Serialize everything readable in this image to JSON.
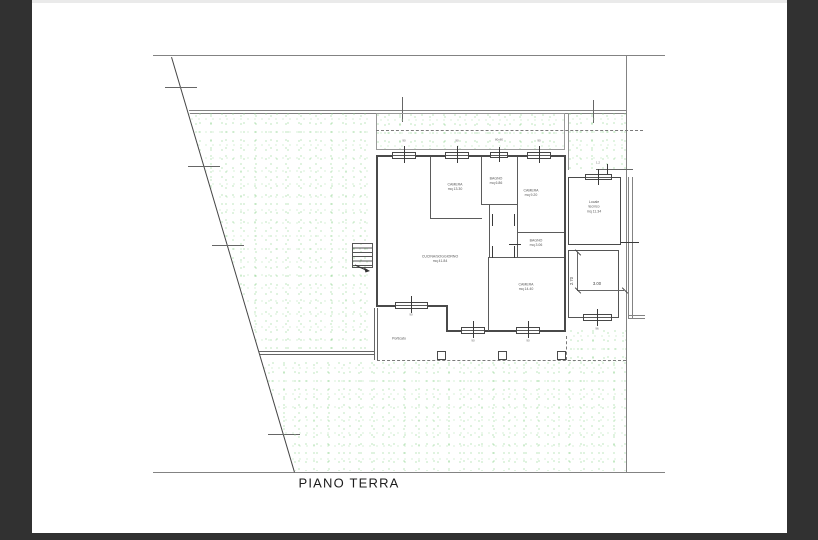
{
  "title": "PIANO TERRA",
  "rooms": {
    "camera1": {
      "label": "CAMERA",
      "area": "mq 13.30"
    },
    "bagno1": {
      "label": "BAGNO",
      "area": "mq 6.86"
    },
    "camera2": {
      "label": "CAMERA",
      "area": "mq 9.20"
    },
    "locale_tecnico": {
      "line1": "Locale",
      "line2": "tecnico",
      "area": "mq 11.34"
    },
    "bagno2": {
      "label": "BAGNO",
      "area": "mq 3.06"
    },
    "cucina": {
      "label": "CUCINA/SOGGIORNO",
      "area": "mq 41.84"
    },
    "camera3": {
      "label": "CAMERA",
      "area": "mq 14.40"
    },
    "porticato": {
      "label": "Porticato"
    }
  },
  "dimensions": {
    "patio_width": "3.00",
    "patio_depth": "2.70"
  },
  "window_labels": {
    "w1": "90",
    "w2": "90",
    "w3": "80x80",
    "w4": "90",
    "w5": "90",
    "w6": "90",
    "w7": "90",
    "w8": "1.2",
    "w9": "96"
  },
  "colors": {
    "frame": "#313131",
    "site_line": "#808080",
    "wall": "#4a4a4a",
    "green_dot": "#8fd48f"
  }
}
